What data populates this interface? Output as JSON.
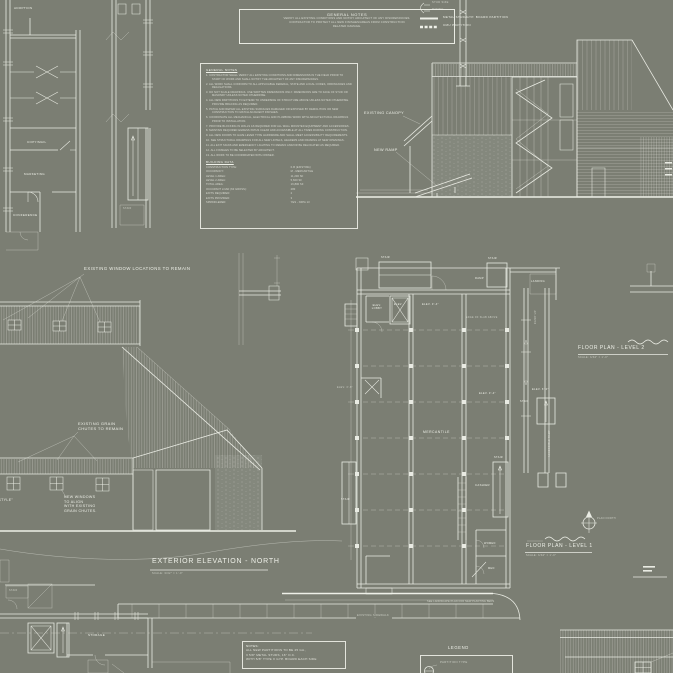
{
  "palette": {
    "background": "#7b7e73",
    "line_bright": "#e9ebe3",
    "line_dim": "#b9bcb2",
    "text": "#eef0e8"
  },
  "top_left_plan": {
    "adoption": "ADOPTION",
    "copy_mail": "COPY/MAIL",
    "marketing": "MARKETING",
    "conference": "CONFERENCE",
    "stair": "STAIR"
  },
  "general_notes_box": {
    "title": "GENERAL NOTES",
    "lines": [
      "VERIFY ALL EXISTING CONDITIONS AND NOTIFY ARCHITECT OF ANY DISCREPANCIES.",
      "CONTRACTOR TO PROTECT ALL NEW FINISHES/AREAS FROM CONSTRUCTION",
      "RELATED DAMAGE."
    ]
  },
  "partition_legend": {
    "stud_size": "STUD SIZE",
    "rating": "RATING",
    "metal_stud": "METAL STUD/GYP. BOARD PARTITION",
    "cmu": "CMU PARTITION"
  },
  "building_section": {
    "existing_canopy": "EXISTING CANOPY",
    "new_ramp": "NEW RAMP"
  },
  "spec_block": {
    "title": "GENERAL NOTES",
    "items": [
      "CONTRACTOR SHALL VERIFY ALL EXISTING CONDITIONS AND DIMENSIONS IN THE FIELD PRIOR TO START OF WORK AND SHALL NOTIFY THE ARCHITECT OF ANY DISCREPANCIES.",
      "ALL WORK SHALL CONFORM TO ALL APPLICABLE FEDERAL, STATE AND LOCAL CODES, ORDINANCES AND REGULATIONS.",
      "DO NOT SCALE DRAWINGS. USE WRITTEN DIMENSIONS ONLY. DIMENSIONS ARE TO FACE OF STUD OR MASONRY UNLESS NOTED OTHERWISE.",
      "ALL NEW PARTITIONS TO EXTEND TO UNDERSIDE OF STRUCTURE ABOVE UNLESS NOTED OTHERWISE. PROVIDE BRACING AS REQUIRED.",
      "PATCH AND REPAIR ALL EXISTING SURFACES DAMAGED OR EXPOSED BY DEMOLITION OR NEW CONSTRUCTION TO MATCH ADJACENT FINISHES.",
      "COORDINATE ALL MECHANICAL, ELECTRICAL AND PLUMBING WORK WITH ARCHITECTURAL DRAWINGS PRIOR TO INSTALLATION.",
      "PROVIDE BLOCKING IN WALLS AS REQUIRED FOR ALL WALL MOUNTED EQUIPMENT AND ACCESSORIES.",
      "MAINTAIN REQUIRED EGRESS PATHS CLEAR AND ACCESSIBLE AT ALL TIMES DURING CONSTRUCTION.",
      "ALL NEW DOORS TO HAVE LEVER TYPE HARDWARE AND SHALL MEET ACCESSIBILITY REQUIREMENTS.",
      "SEE STRUCTURAL DRAWINGS FOR ALL NEW LINTELS, HEADERS AND FRAMING AT NEW OPENINGS.",
      "ALL EXIT SIGNS AND EMERGENCY LIGHTING TO REMAIN AND/OR BE RELOCATED AS REQUIRED.",
      "ALL FINISHES TO BE SELECTED BY ARCHITECT.",
      "ALL WORK TO BE COORDINATED WITH OWNER."
    ],
    "data_title": "BUILDING DATA",
    "data_rows": [
      {
        "label": "CONSTRUCTION TYPE:",
        "value": "II-B (EXISTING)"
      },
      {
        "label": "OCCUPANCY:",
        "value": "M - MERCANTILE"
      },
      {
        "label": "LEVEL 1 AREA:",
        "value": "11,200 SF"
      },
      {
        "label": "LEVEL 2 AREA:",
        "value": "5,600 SF"
      },
      {
        "label": "TOTAL AREA:",
        "value": "16,800 SF"
      },
      {
        "label": "OCCUPANT LOAD (60 GROSS):",
        "value": "280"
      },
      {
        "label": "EXITS REQUIRED:",
        "value": "2"
      },
      {
        "label": "EXITS PROVIDED:",
        "value": "3"
      },
      {
        "label": "SPRINKLERED:",
        "value": "YES - NFPA 13"
      }
    ]
  },
  "north_elevation": {
    "window_note": "EXISTING WINDOW LOCATIONS TO REMAIN",
    "grain_note": "EXISTING GRAIN\nCHUTES TO REMAIN",
    "new_windows_note": "NEW WINDOWS\nTO ALIGN\nWITH EXISTING\nGRAIN CHUTES.",
    "barn_doors_note": "NEW\n\"BARN STYLE\"\nDOORS",
    "title": "EXTERIOR ELEVATION - NORTH",
    "scale": "SCALE: 3/32\" = 1'-0\""
  },
  "floor_plan": {
    "mercantile": "MERCANTILE",
    "elev_lobby": "ELEV.\nLOBBY",
    "elev": "ELEV.",
    "stair": "STAIR",
    "ramp": "RAMP",
    "landing": "LANDING",
    "cashier": "CASHIER",
    "women": "WOMEN",
    "men": "MEN",
    "storage": "STORAGE",
    "ramp_up": "RAMP UP",
    "accessible_ramp": "ACCESSIBLE RAMP",
    "elev_3_4": "ELEV. 3'-4\"",
    "elev_3_8": "ELEV. 3'-8\"",
    "elev_6_0": "ELEV. 6'-0\"",
    "edge_note": "EDGE OF SLAB ABOVE"
  },
  "plan_titles": {
    "level2": "FLOOR PLAN - LEVEL 2",
    "level2_scale": "SCALE: 3/32\" = 1'-0\"",
    "level1": "FLOOR PLAN - LEVEL 1",
    "level1_scale": "SCALE: 3/32\" = 1'-0\"",
    "plan_north": "PLAN NORTH"
  },
  "site": {
    "sidewalk": "EXISTING SIDEWALK",
    "landscape_note": "SEE LANDSCAPE PLAN FOR NEW PLANTING BEDS"
  },
  "notes_box": {
    "title": "NOTES:",
    "lines": [
      "ALL NEW PARTITIONS TO BE 25 GA.,",
      "3 5/8\" METAL STUDS, 16\" O.C.",
      "WITH 5/8\" TYPE X GYP. BOARD EACH SIDE"
    ]
  },
  "legend_box": {
    "title": "LEGEND",
    "partition_type": "PARTITION TYPE"
  }
}
